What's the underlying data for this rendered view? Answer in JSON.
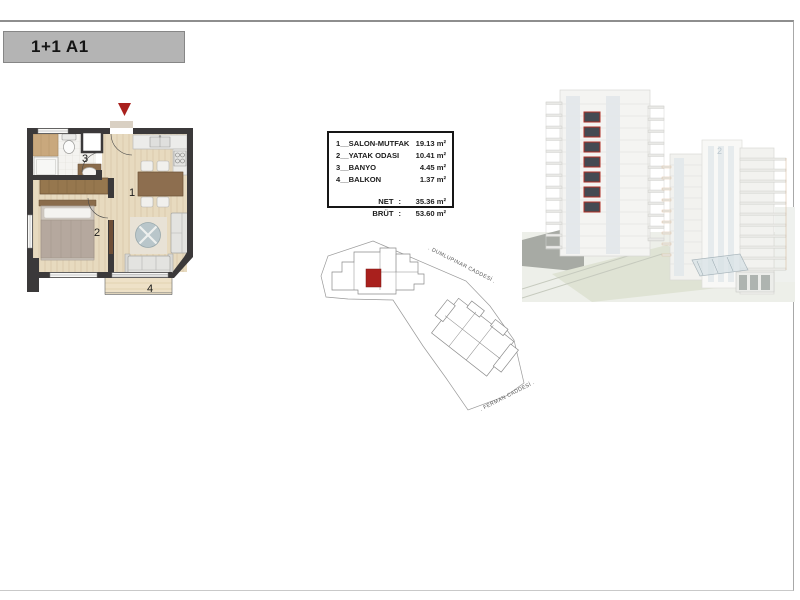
{
  "badge": {
    "label": "1+1 A1"
  },
  "legend": {
    "rows": [
      {
        "label": "1__SALON-MUTFAK",
        "area": "19.13 m²"
      },
      {
        "label": "2__YATAK ODASI",
        "area": "10.41 m²"
      },
      {
        "label": "3__BANYO",
        "area": "4.45 m²"
      },
      {
        "label": "4__BALKON",
        "area": "1.37 m²"
      }
    ],
    "net": {
      "label": "NET",
      "colon": ":",
      "value": "35.36 m²"
    },
    "brut": {
      "label": "BRÜT",
      "colon": ":",
      "value": "53.60 m²"
    }
  },
  "floor_plan": {
    "rooms": {
      "living": "1",
      "bedroom": "2",
      "bath": "3",
      "balcony": "4"
    },
    "accent_color": "#a9201d"
  },
  "site_plan": {
    "street_top": ". DUMLUPINAR CADDESİ .",
    "street_bottom": ". FERMAN CADDESİ .",
    "highlight_color": "#a9201d"
  },
  "render": {
    "tower_label": "2"
  }
}
